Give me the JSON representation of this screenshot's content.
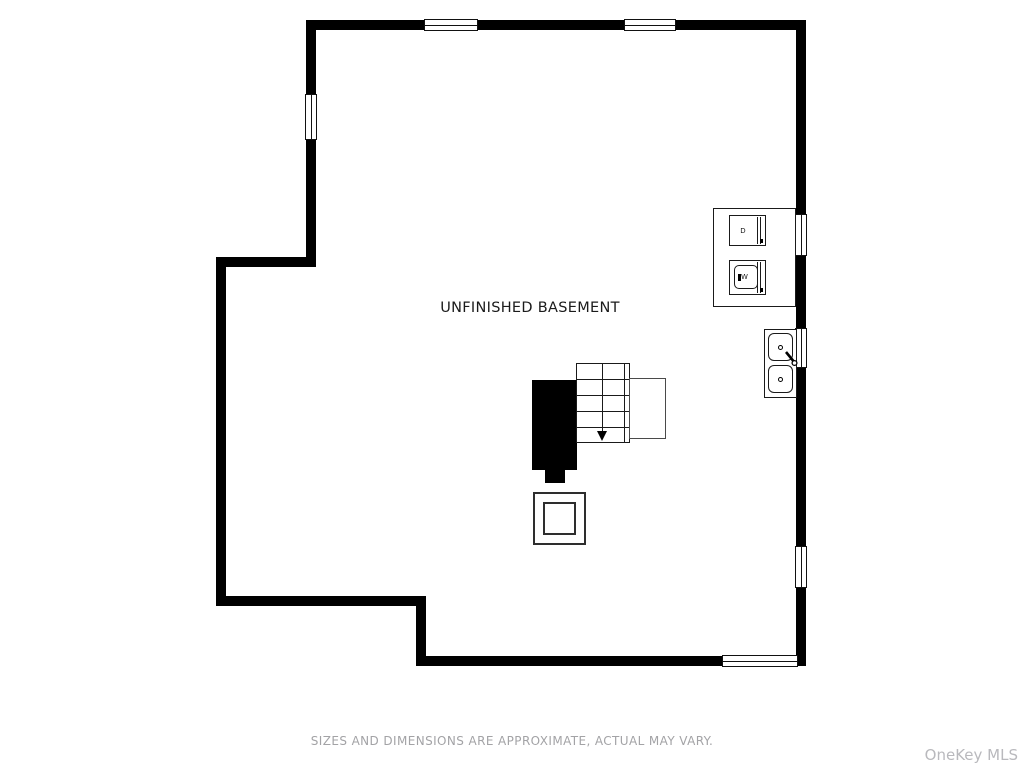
{
  "plan": {
    "room_label": "UNFINISHED BASEMENT",
    "type": "basement-floor-plan",
    "appliances": {
      "dryer_label": "D",
      "washer_label": "W"
    },
    "stairs": {
      "direction": "down",
      "tread_rows": 5
    },
    "icons": {
      "stairs-down-arrow": "▼"
    }
  },
  "footer": {
    "disclaimer": "SIZES AND DIMENSIONS ARE APPROXIMATE, ACTUAL MAY VARY.",
    "watermark": "OneKey MLS"
  },
  "colors": {
    "wall": "#000000",
    "fixture_outline": "#1a1a1a",
    "landing_outline": "#4a4a4a",
    "room_label_text": "#1b1b1b",
    "disclaimer_text": "#a3a3a6",
    "watermark_text": "#b9b9bd",
    "background": "#ffffff"
  }
}
